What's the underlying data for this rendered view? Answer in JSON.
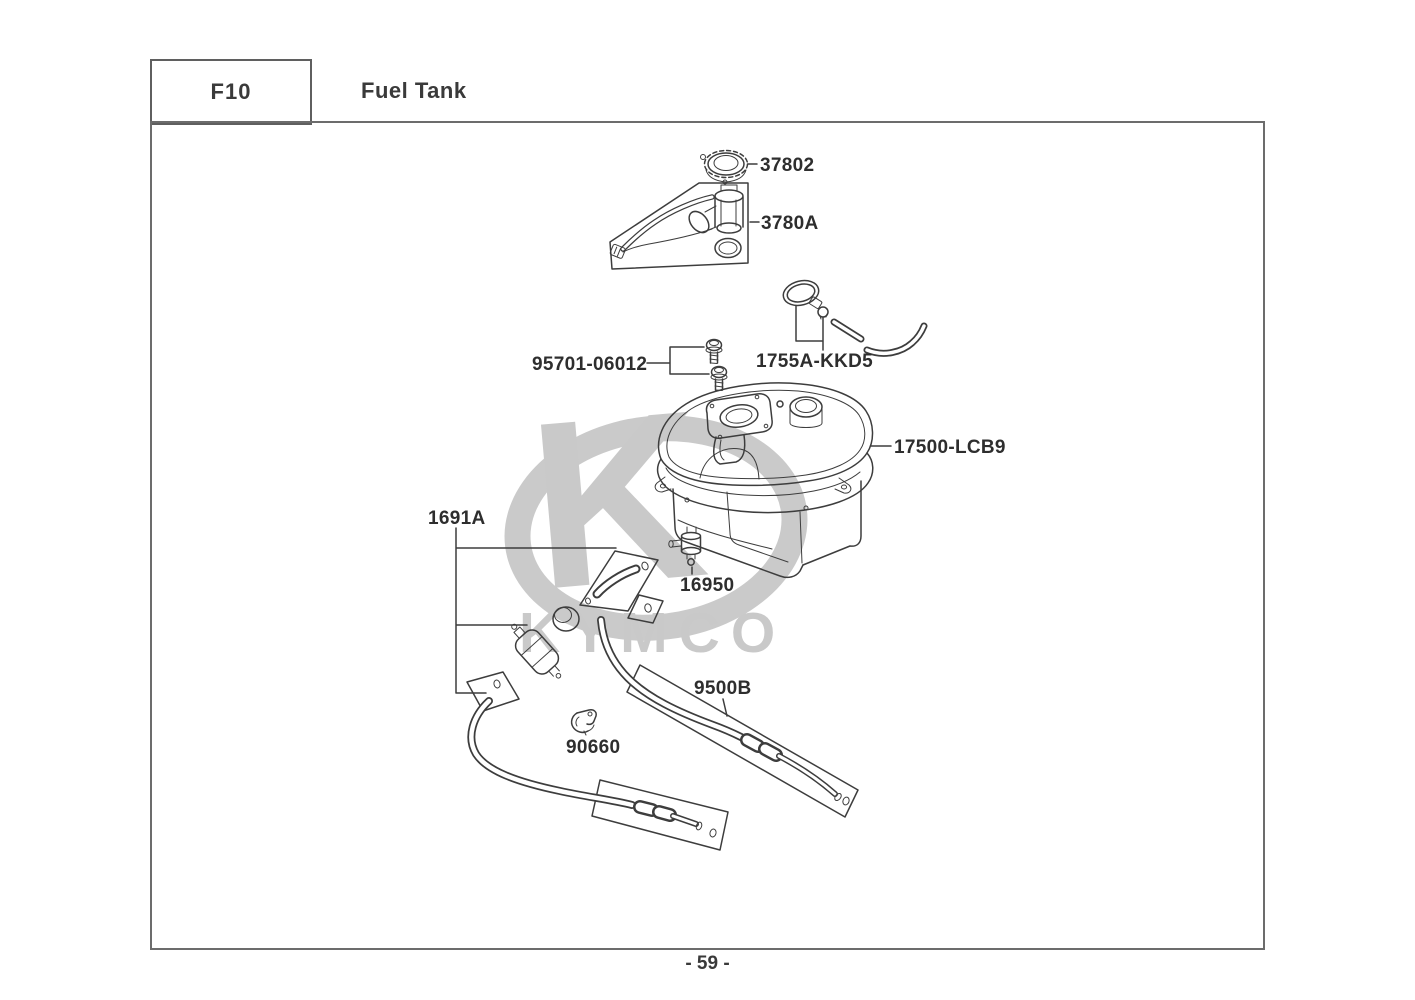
{
  "header": {
    "section_code": "F10",
    "section_title": "Fuel Tank"
  },
  "watermark": {
    "monogram": "K",
    "brand": "KYMCO"
  },
  "parts": [
    {
      "part_number": "37802",
      "drawing": "fuel-filler-cap"
    },
    {
      "part_number": "3780A",
      "drawing": "fuel-pump-unit"
    },
    {
      "part_number": "95701-06012",
      "drawing": "flange-bolts"
    },
    {
      "part_number": "1755A-KKD5",
      "drawing": "clamp-and-tube-set"
    },
    {
      "part_number": "17500-LCB9",
      "drawing": "fuel-tank-body"
    },
    {
      "part_number": "1691A",
      "drawing": "fuel-filter-tube-set"
    },
    {
      "part_number": "16950",
      "drawing": "fuel-cock"
    },
    {
      "part_number": "9500B",
      "drawing": "fuel-hose"
    },
    {
      "part_number": "90660",
      "drawing": "hose-clip"
    }
  ],
  "footer": {
    "page_number": "- 59 -"
  },
  "colors": {
    "line_ink": "#3d3d3d",
    "label_ink": "#2e2e2e",
    "frame_border": "#6c6c6c",
    "watermark_gray": "#c9c9c9"
  }
}
